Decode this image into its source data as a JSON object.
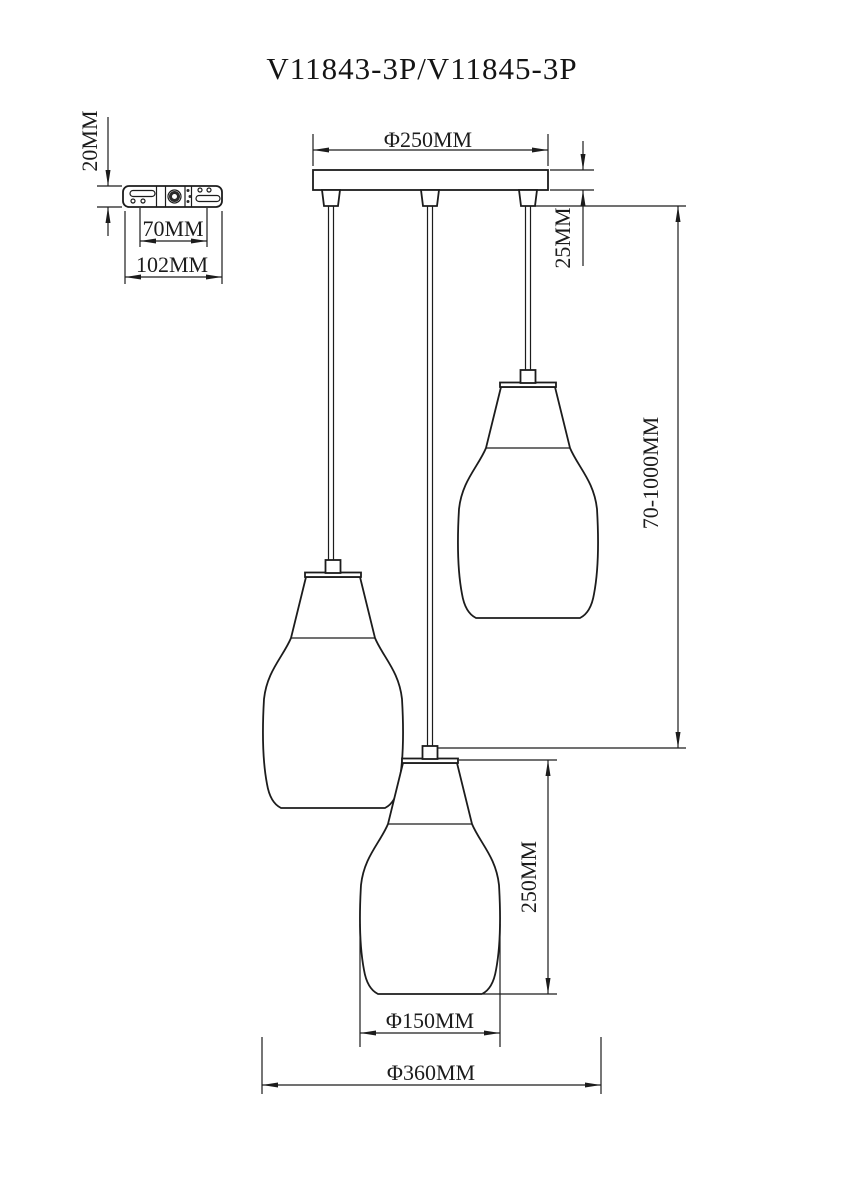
{
  "title": "V11843-3P/V11845-3P",
  "dimensions": {
    "bracket_thickness": "20MM",
    "bracket_hole_spacing": "70MM",
    "bracket_width": "102MM",
    "canopy_diameter": "Φ250MM",
    "canopy_height": "25MM",
    "suspension_length": "70-1000MM",
    "shade_height": "250MM",
    "shade_diameter": "Φ150MM",
    "overall_diameter": "Φ360MM"
  },
  "colors": {
    "line": "#1c1c1c",
    "background": "#ffffff"
  }
}
